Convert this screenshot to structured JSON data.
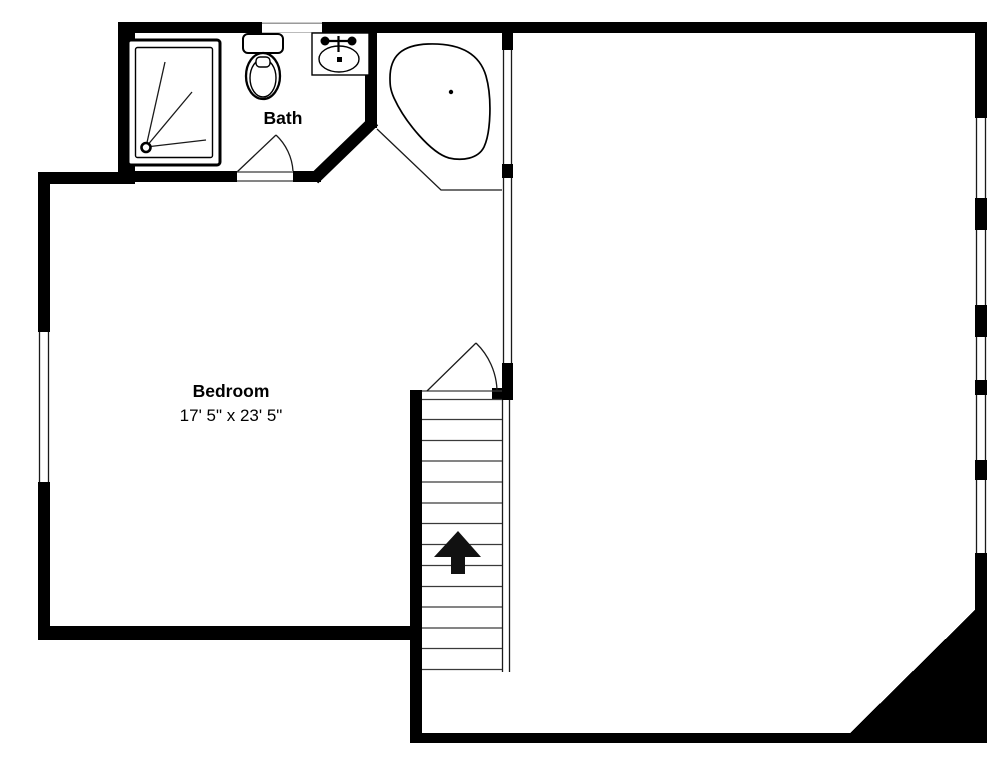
{
  "title": "Upper floor plan",
  "rooms": {
    "bath": {
      "label": "Bath"
    },
    "bedroom": {
      "label": "Bedroom",
      "dimensions": "17' 5\" x 23' 5\""
    }
  },
  "stairs": {
    "direction": "up-arrow"
  },
  "fixtures": [
    "shower-stall",
    "toilet",
    "sink-vanity",
    "corner-bathtub"
  ],
  "colors": {
    "wall": "#000000",
    "background": "#ffffff",
    "detail_line": "#333333"
  }
}
